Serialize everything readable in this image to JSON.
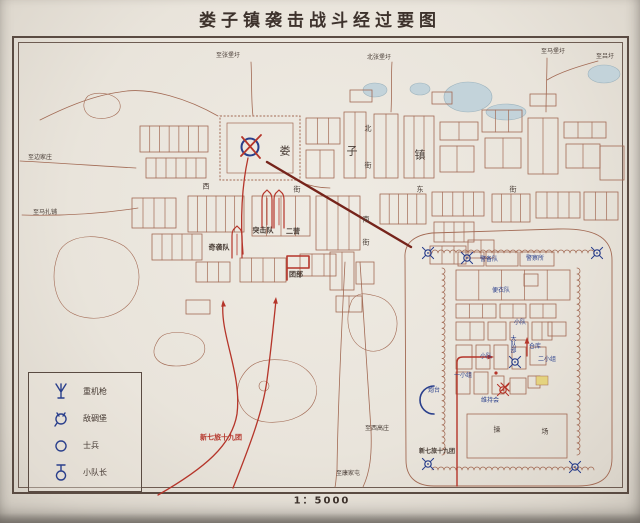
{
  "title": "娄子镇袭击战斗经过要图",
  "scale_label": "1：5000",
  "colors": {
    "paper": "#eae5dc",
    "frame": "#5a4b42",
    "ink": "#473b34",
    "map_line": "#a26a54",
    "red": "#b5352a",
    "blue": "#2a3f8c",
    "pond_fill": "#c3d3da",
    "pond_edge": "#9db3bd",
    "leader_line": "#76241b",
    "highlight_yellow": "#e4d37f"
  },
  "legend": {
    "items": [
      {
        "icon": "heavy-machine-gun-icon",
        "label": "重机枪"
      },
      {
        "icon": "enemy-pillbox-icon",
        "label": "敌碉堡"
      },
      {
        "icon": "soldier-icon",
        "label": "士兵"
      },
      {
        "icon": "squad-leader-icon",
        "label": "小队长"
      }
    ]
  },
  "map_labels": [
    {
      "t": "至张堡圩",
      "x": 228,
      "y": 56,
      "c": "ink",
      "s": 6
    },
    {
      "t": "北张堡圩",
      "x": 379,
      "y": 58,
      "c": "ink",
      "s": 6
    },
    {
      "t": "至马堡圩",
      "x": 553,
      "y": 52,
      "c": "ink",
      "s": 6
    },
    {
      "t": "至吕圩",
      "x": 605,
      "y": 57,
      "c": "ink",
      "s": 6
    },
    {
      "t": "至边家庄",
      "x": 40,
      "y": 158,
      "c": "ink",
      "s": 6
    },
    {
      "t": "至马扎铺",
      "x": 45,
      "y": 213,
      "c": "ink",
      "s": 6
    },
    {
      "t": "至西高庄",
      "x": 377,
      "y": 429,
      "c": "ink",
      "s": 6
    },
    {
      "t": "至康家屯",
      "x": 348,
      "y": 474,
      "c": "ink",
      "s": 6
    },
    {
      "t": "娄",
      "x": 285,
      "y": 151,
      "c": "ink",
      "s": 11
    },
    {
      "t": "子",
      "x": 352,
      "y": 151,
      "c": "ink",
      "s": 11
    },
    {
      "t": "镇",
      "x": 420,
      "y": 155,
      "c": "ink",
      "s": 11
    },
    {
      "t": "北",
      "x": 368,
      "y": 129,
      "c": "ink",
      "s": 7
    },
    {
      "t": "街",
      "x": 368,
      "y": 166,
      "c": "ink",
      "s": 7
    },
    {
      "t": "南",
      "x": 366,
      "y": 220,
      "c": "ink",
      "s": 7
    },
    {
      "t": "街",
      "x": 366,
      "y": 243,
      "c": "ink",
      "s": 7
    },
    {
      "t": "西",
      "x": 206,
      "y": 187,
      "c": "ink",
      "s": 7
    },
    {
      "t": "街",
      "x": 297,
      "y": 190,
      "c": "ink",
      "s": 7
    },
    {
      "t": "东",
      "x": 420,
      "y": 190,
      "c": "ink",
      "s": 7
    },
    {
      "t": "街",
      "x": 513,
      "y": 190,
      "c": "ink",
      "s": 7
    },
    {
      "t": "奇袭队",
      "x": 219,
      "y": 248,
      "c": "ink",
      "s": 7,
      "b": 1
    },
    {
      "t": "突击队",
      "x": 263,
      "y": 231,
      "c": "ink",
      "s": 7,
      "b": 1
    },
    {
      "t": "二营",
      "x": 293,
      "y": 232,
      "c": "ink",
      "s": 7,
      "b": 1
    },
    {
      "t": "团部",
      "x": 296,
      "y": 275,
      "c": "ink",
      "s": 7,
      "b": 1
    },
    {
      "t": "新七旅十九团",
      "x": 221,
      "y": 438,
      "c": "red",
      "s": 7,
      "b": 1
    }
  ],
  "inset_labels": [
    {
      "t": "警备队",
      "x": 489,
      "y": 260,
      "c": "blue",
      "s": 6
    },
    {
      "t": "警察所",
      "x": 535,
      "y": 259,
      "c": "blue",
      "s": 6
    },
    {
      "t": "便衣队",
      "x": 501,
      "y": 291,
      "c": "blue",
      "s": 6
    },
    {
      "t": "小队",
      "x": 520,
      "y": 323,
      "c": "blue",
      "s": 6
    },
    {
      "t": "大队部",
      "x": 512,
      "y": 344,
      "c": "blue",
      "s": 6,
      "v": 1
    },
    {
      "t": "仓库",
      "x": 535,
      "y": 347,
      "c": "blue",
      "s": 6
    },
    {
      "t": "二小组",
      "x": 547,
      "y": 360,
      "c": "blue",
      "s": 6
    },
    {
      "t": "小队",
      "x": 486,
      "y": 357,
      "c": "blue",
      "s": 6
    },
    {
      "t": "一小组",
      "x": 463,
      "y": 376,
      "c": "blue",
      "s": 6
    },
    {
      "t": "维持会",
      "x": 490,
      "y": 401,
      "c": "blue",
      "s": 6
    },
    {
      "t": "炮台",
      "x": 434,
      "y": 391,
      "c": "blue",
      "s": 6
    },
    {
      "t": "操",
      "x": 497,
      "y": 430,
      "c": "ink",
      "s": 7
    },
    {
      "t": "场",
      "x": 545,
      "y": 432,
      "c": "ink",
      "s": 7
    },
    {
      "t": "新七旅十九团",
      "x": 437,
      "y": 452,
      "c": "ink",
      "s": 6,
      "b": 1
    }
  ]
}
